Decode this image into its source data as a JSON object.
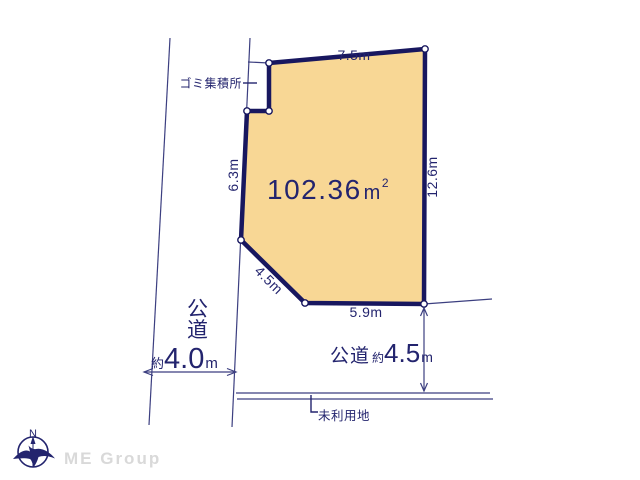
{
  "parcel": {
    "area": {
      "value": "102.36",
      "unit": "m",
      "sup": "2"
    },
    "fill_color": "#f8d795",
    "border_color": "#18175f"
  },
  "dimensions": {
    "top": "7.5m",
    "right": "12.6m",
    "left": "6.3m",
    "diagonal": "4.5m",
    "bottom": "5.9m"
  },
  "annotations": {
    "garbage_station": "ゴミ集積所",
    "unused_land": "未利用地"
  },
  "roads": {
    "left": {
      "name": "公道",
      "approx": "約",
      "width": "4.0",
      "unit": "m"
    },
    "bottom": {
      "name": "公道",
      "approx": "約",
      "width": "4.5",
      "unit": "m"
    }
  },
  "compass": {
    "north": "N"
  },
  "watermark": "ME Group",
  "colors": {
    "text_navy": "#23246e",
    "thin_line": "#3c3f80",
    "parcel_fill": "#f8d795",
    "parcel_border": "#18175f",
    "watermark_gray": "#d9d9d9"
  }
}
